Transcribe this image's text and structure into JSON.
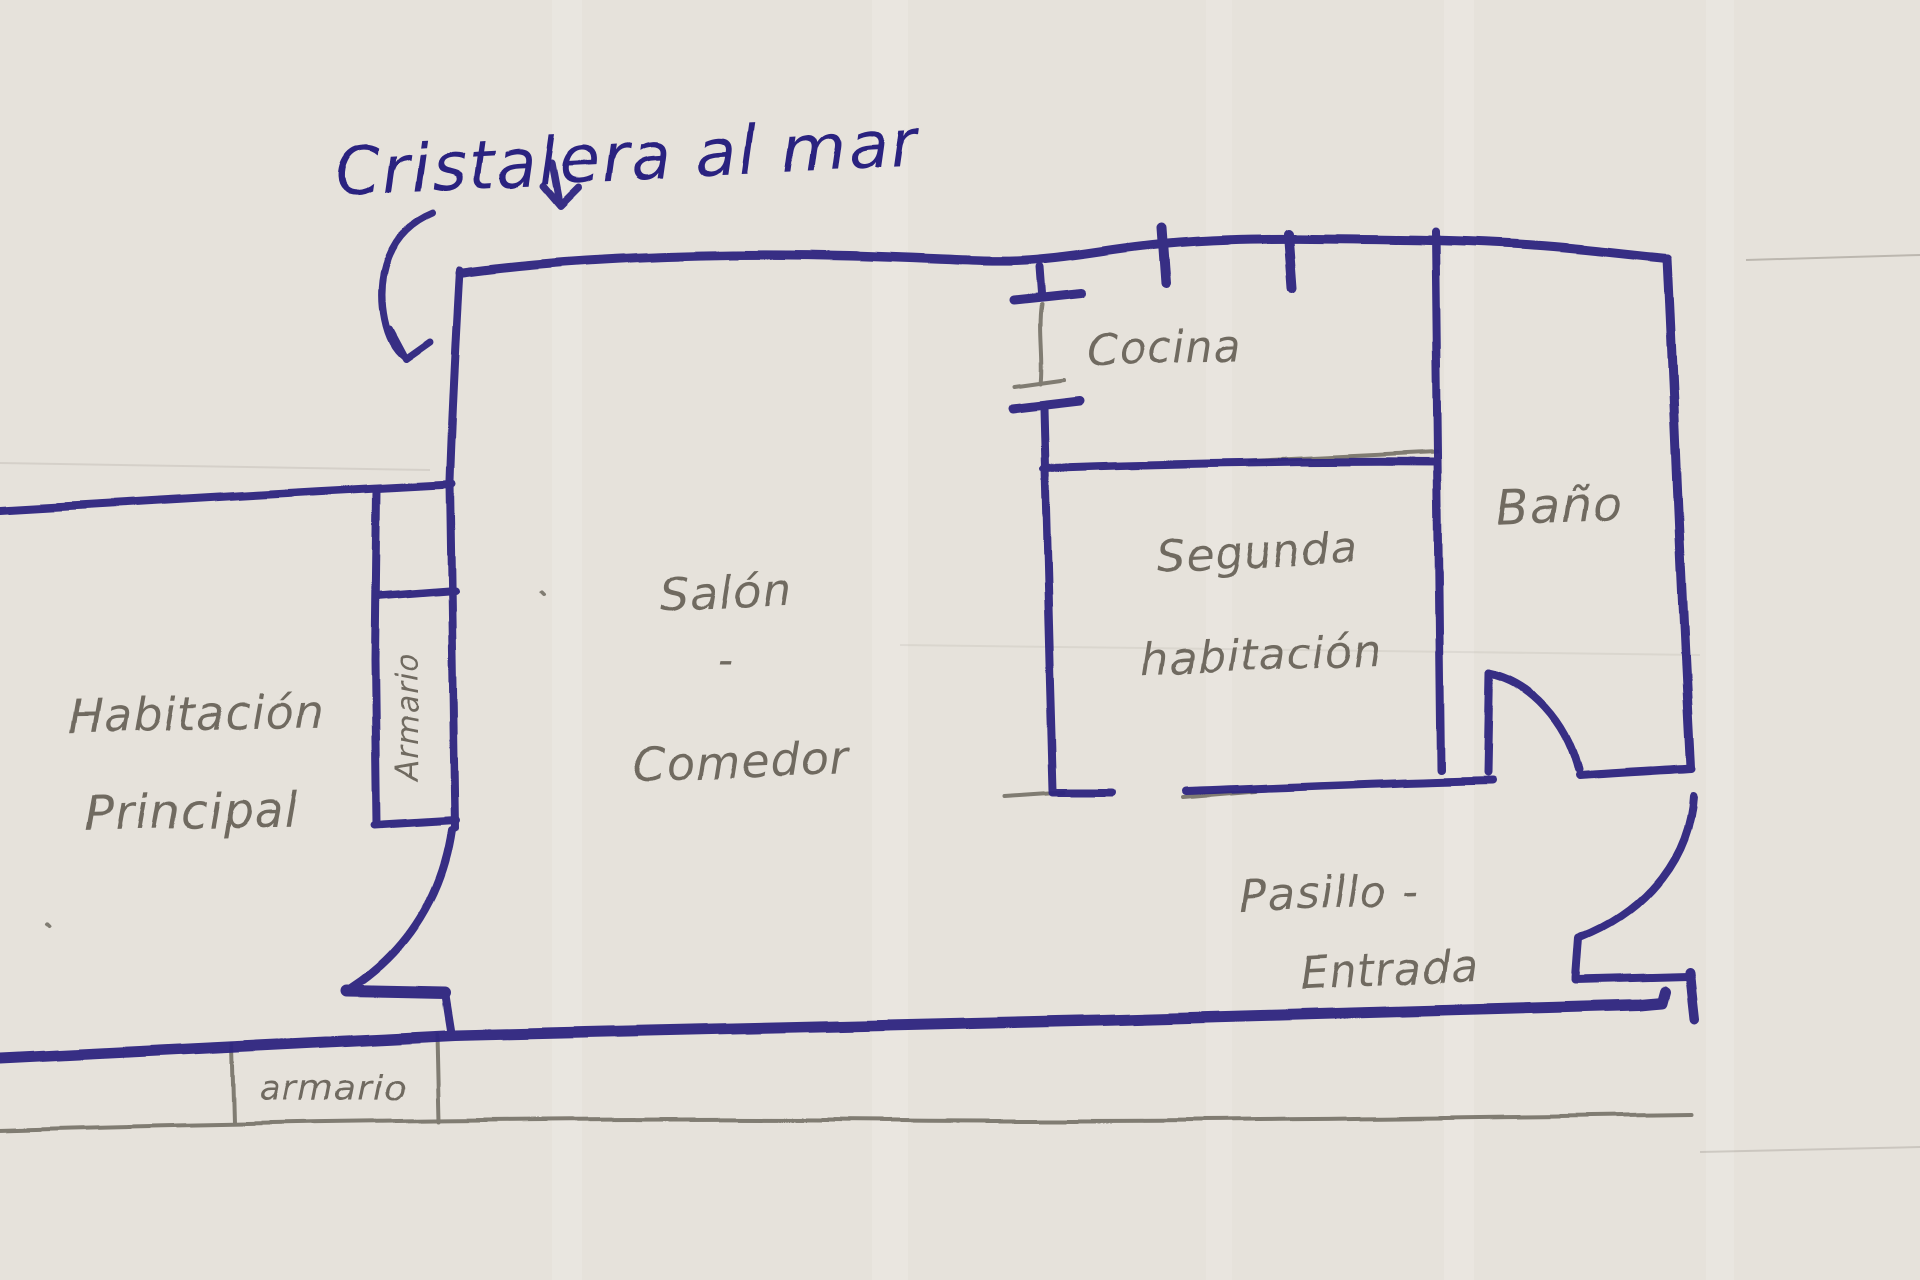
{
  "title": {
    "label": "Cristalera al mar"
  },
  "colors": {
    "ink": "#2c2380",
    "pencil": "#6f6a60",
    "paper": "#e6e2db"
  },
  "rooms": {
    "habitacion_principal": {
      "line1": "Habitación",
      "line2": "Principal"
    },
    "armario_pared": {
      "label": "Armario"
    },
    "salon": {
      "line1": "Salón",
      "separator": "-",
      "line2": "Comedor"
    },
    "cocina": {
      "label": "Cocina"
    },
    "segunda_habitacion": {
      "line1": "Segunda",
      "line2": "habitación"
    },
    "bano": {
      "label": "Baño"
    },
    "pasillo": {
      "line1": "Pasillo -",
      "line2": "Entrada"
    },
    "armario_inferior": {
      "label": "armario"
    }
  }
}
